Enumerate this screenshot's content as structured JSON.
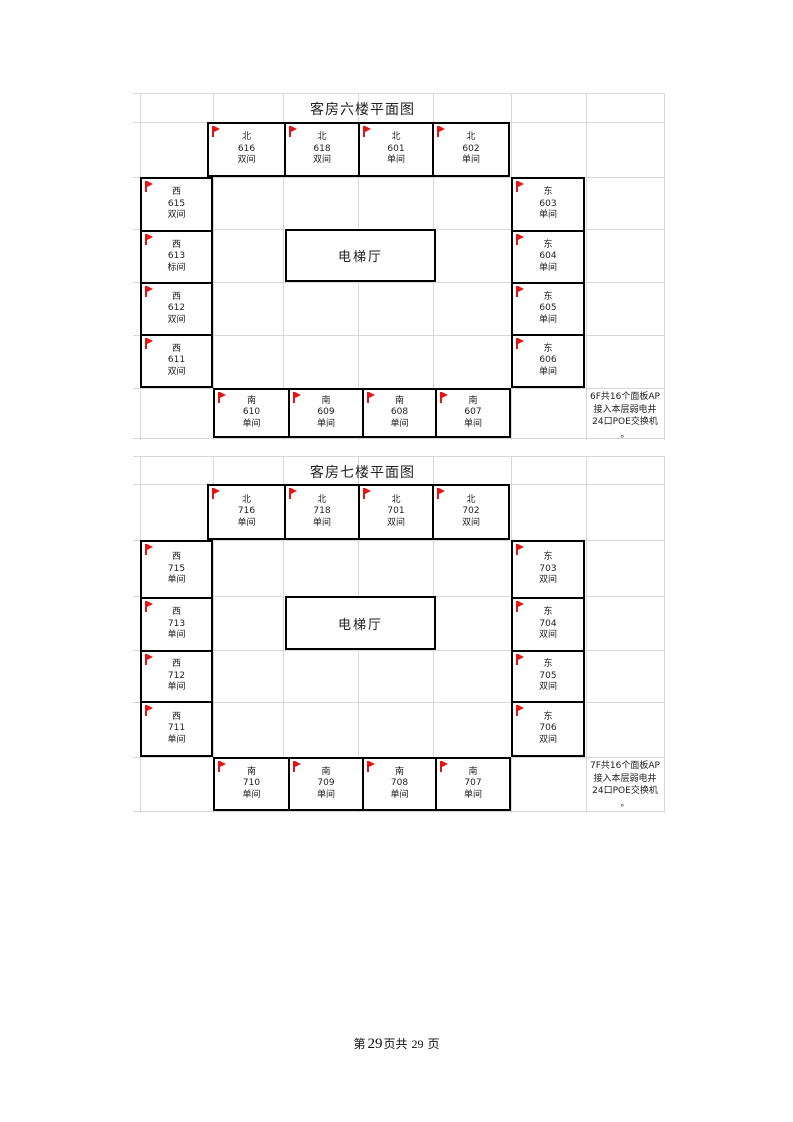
{
  "document": {
    "footer": {
      "prefix": "第",
      "page_number": "29",
      "middle": "页共",
      "total_pages": "29",
      "suffix": "页"
    }
  },
  "colors": {
    "flag_red": "#e01515",
    "room_border": "#000000",
    "grid_line": "#d8d8d8"
  },
  "icons": {
    "ap_flag": "⚑"
  },
  "floors": [
    {
      "id": "6F",
      "title": "客房六楼平面图",
      "elevator_label": "电梯厅",
      "note_lines": [
        "6F共16个面板AP",
        "接入本层弱电井",
        "24口POE交换机",
        "。"
      ],
      "north_rooms": [
        {
          "direction": "北",
          "number": "616",
          "type": "双间"
        },
        {
          "direction": "北",
          "number": "618",
          "type": "双间"
        },
        {
          "direction": "北",
          "number": "601",
          "type": "单间"
        },
        {
          "direction": "北",
          "number": "602",
          "type": "单间"
        }
      ],
      "west_rooms": [
        {
          "direction": "西",
          "number": "615",
          "type": "双间"
        },
        {
          "direction": "西",
          "number": "613",
          "type": "标间"
        },
        {
          "direction": "西",
          "number": "612",
          "type": "双间"
        },
        {
          "direction": "西",
          "number": "611",
          "type": "双间"
        }
      ],
      "east_rooms": [
        {
          "direction": "东",
          "number": "603",
          "type": "单间"
        },
        {
          "direction": "东",
          "number": "604",
          "type": "单间"
        },
        {
          "direction": "东",
          "number": "605",
          "type": "单间"
        },
        {
          "direction": "东",
          "number": "606",
          "type": "单间"
        }
      ],
      "south_rooms": [
        {
          "direction": "南",
          "number": "610",
          "type": "单间"
        },
        {
          "direction": "南",
          "number": "609",
          "type": "单间"
        },
        {
          "direction": "南",
          "number": "608",
          "type": "单间"
        },
        {
          "direction": "南",
          "number": "607",
          "type": "单间"
        }
      ]
    },
    {
      "id": "7F",
      "title": "客房七楼平面图",
      "elevator_label": "电梯厅",
      "note_lines": [
        "7F共16个面板AP",
        "接入本层弱电井",
        "24口POE交换机",
        "。"
      ],
      "north_rooms": [
        {
          "direction": "北",
          "number": "716",
          "type": "单间"
        },
        {
          "direction": "北",
          "number": "718",
          "type": "单间"
        },
        {
          "direction": "北",
          "number": "701",
          "type": "双间"
        },
        {
          "direction": "北",
          "number": "702",
          "type": "双间"
        }
      ],
      "west_rooms": [
        {
          "direction": "西",
          "number": "715",
          "type": "单间"
        },
        {
          "direction": "西",
          "number": "713",
          "type": "单间"
        },
        {
          "direction": "西",
          "number": "712",
          "type": "单间"
        },
        {
          "direction": "西",
          "number": "711",
          "type": "单间"
        }
      ],
      "east_rooms": [
        {
          "direction": "东",
          "number": "703",
          "type": "双间"
        },
        {
          "direction": "东",
          "number": "704",
          "type": "双间"
        },
        {
          "direction": "东",
          "number": "705",
          "type": "双间"
        },
        {
          "direction": "东",
          "number": "706",
          "type": "双间"
        }
      ],
      "south_rooms": [
        {
          "direction": "南",
          "number": "710",
          "type": "单间"
        },
        {
          "direction": "南",
          "number": "709",
          "type": "单间"
        },
        {
          "direction": "南",
          "number": "708",
          "type": "单间"
        },
        {
          "direction": "南",
          "number": "707",
          "type": "单间"
        }
      ]
    }
  ]
}
